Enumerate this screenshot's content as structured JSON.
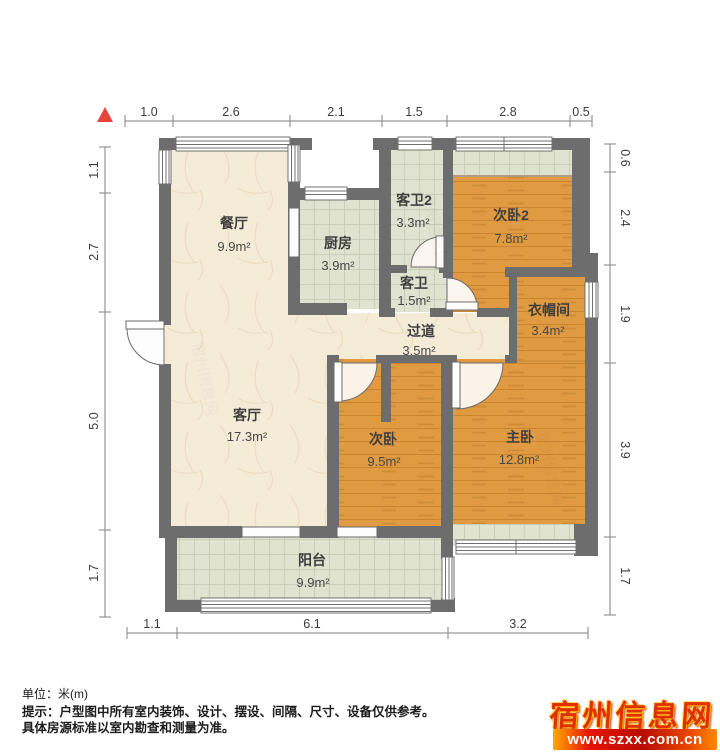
{
  "plan": {
    "unit_label": "单位：米(m)",
    "note_line1": "提示：户型图中所有室内装饰、设计、摆设、间隔、尺寸、设备仅供参考。",
    "note_line2": "具体房源标准以室内勘查和测量为准。"
  },
  "dimensions": {
    "top": [
      "1.0",
      "2.6",
      "2.1",
      "1.5",
      "2.8",
      "0.5"
    ],
    "left": [
      "1.1",
      "2.7",
      "5.0",
      "1.7"
    ],
    "right": [
      "0.6",
      "2.4",
      "1.9",
      "3.9",
      "1.7"
    ],
    "bottom": [
      "1.1",
      "6.1",
      "3.2"
    ]
  },
  "rooms": {
    "dining": {
      "name": "餐厅",
      "area": "9.9m²"
    },
    "kitchen": {
      "name": "厨房",
      "area": "3.9m²"
    },
    "bath2": {
      "name": "客卫2",
      "area": "3.3m²"
    },
    "bedroom2": {
      "name": "次卧2",
      "area": "7.8m²"
    },
    "bath": {
      "name": "客卫",
      "area": "1.5m²"
    },
    "hallway": {
      "name": "过道",
      "area": "3.5m²"
    },
    "cloakroom": {
      "name": "衣帽间",
      "area": "3.4m²"
    },
    "living": {
      "name": "客厅",
      "area": "17.3m²"
    },
    "bedroom": {
      "name": "次卧",
      "area": "9.5m²"
    },
    "master": {
      "name": "主卧",
      "area": "12.8m²"
    },
    "balcony": {
      "name": "阳台",
      "area": "9.9m²"
    }
  },
  "watermark": {
    "site_name": "宿州信息网",
    "site_url": "www.szxx.com.cn"
  },
  "colors": {
    "wall": "#6d6d6d",
    "wood_floor": "#e09a42",
    "tile_floor": "#e0e3d0",
    "marble_floor": "#f5ecd8",
    "north_marker_red": "#e8453a",
    "watermark_red": "#e03000"
  }
}
